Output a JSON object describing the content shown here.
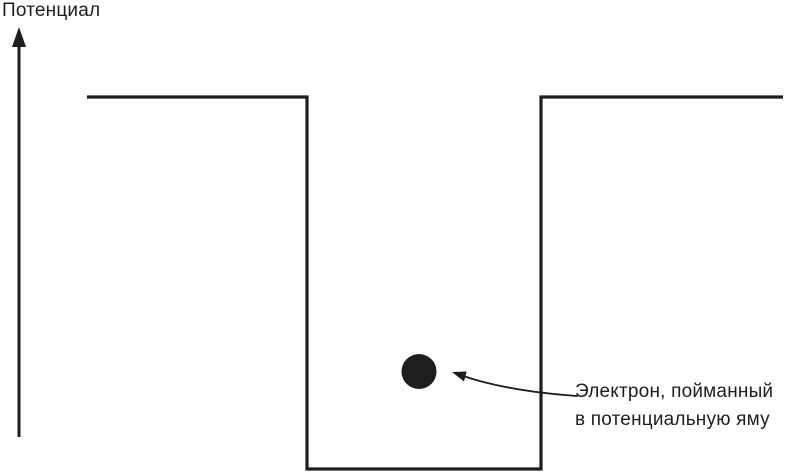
{
  "axis": {
    "title": "Потенциал"
  },
  "annotation": {
    "line1": "Электрон, пойманный",
    "line2": "в потенциальную яму"
  },
  "colors": {
    "ink": "#1e1e1e",
    "background": "#ffffff"
  }
}
